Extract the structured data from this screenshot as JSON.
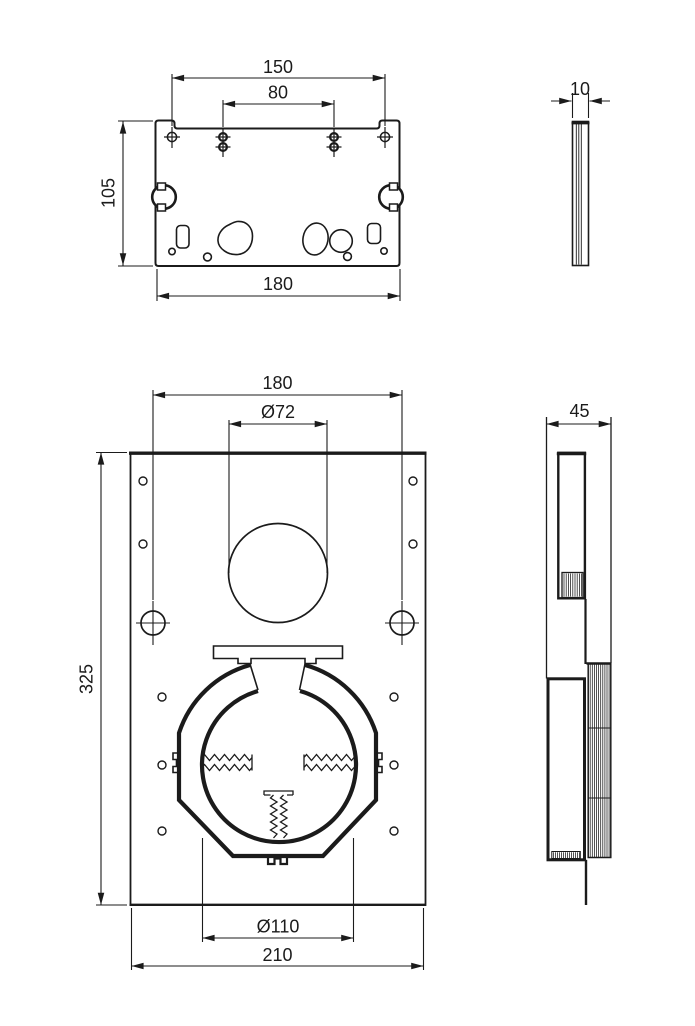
{
  "drawing": {
    "kind": "technical dimension drawing",
    "background": "#ffffff",
    "line_color": "#1b1b1b",
    "views": {
      "bracket_front": {
        "label": "top bracket front view",
        "dim_hole_spacing_outer": "150",
        "dim_hole_spacing_inner": "80",
        "dim_height": "105",
        "dim_width": "180"
      },
      "bracket_side": {
        "label": "top bracket side view",
        "dim_thickness": "10"
      },
      "plate_front": {
        "label": "mounting plate front view",
        "dim_hole_spacing": "180",
        "dim_top_hole_diameter": "Ø72",
        "dim_height": "325",
        "dim_clamp_diameter": "Ø110",
        "dim_width": "210"
      },
      "plate_side": {
        "label": "mounting plate side view",
        "dim_depth": "45"
      }
    }
  }
}
